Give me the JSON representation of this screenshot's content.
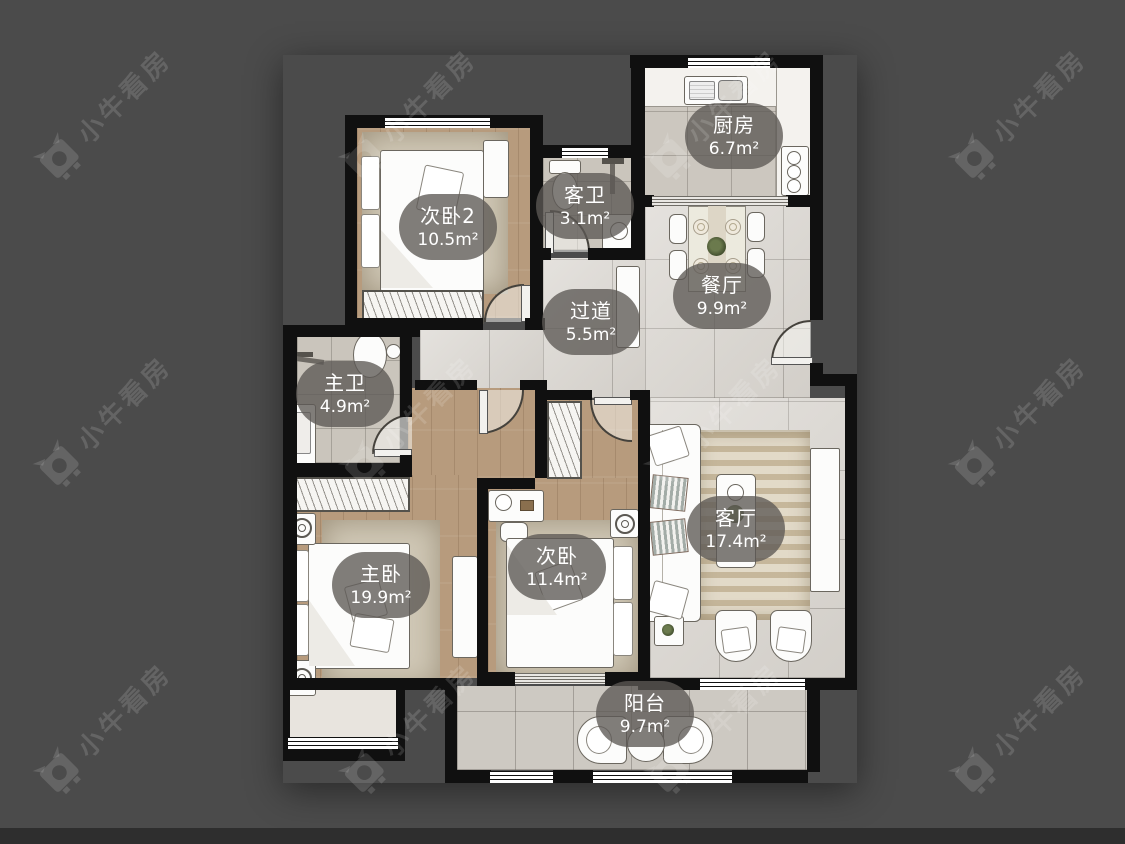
{
  "app": {
    "watermark_text": "小牛看房",
    "watermark_logo": "xiaoniu-bull-icon"
  },
  "rooms": [
    {
      "id": "bedroom2",
      "name": "次卧2",
      "area": "10.5m²"
    },
    {
      "id": "guest-bath",
      "name": "客卫",
      "area": "3.1m²"
    },
    {
      "id": "kitchen",
      "name": "厨房",
      "area": "6.7m²"
    },
    {
      "id": "hallway",
      "name": "过道",
      "area": "5.5m²"
    },
    {
      "id": "dining",
      "name": "餐厅",
      "area": "9.9m²"
    },
    {
      "id": "master-bath",
      "name": "主卫",
      "area": "4.9m²"
    },
    {
      "id": "master-bedroom",
      "name": "主卧",
      "area": "19.9m²"
    },
    {
      "id": "bedroom",
      "name": "次卧",
      "area": "11.4m²"
    },
    {
      "id": "living",
      "name": "客厅",
      "area": "17.4m²"
    },
    {
      "id": "balcony",
      "name": "阳台",
      "area": "9.7m²"
    }
  ],
  "colors": {
    "background": "#4b4b4b",
    "wall": "#101010",
    "wood_floor": "#b79b7d",
    "tile_floor": "#d9d5cf",
    "bath_tile": "#cac5bc",
    "kitchen_tile": "#ccc7bf",
    "balcony_tile": "#cdc9c2",
    "label_bubble": "rgba(92,89,85,0.78)",
    "label_text": "#ffffff",
    "watermark": "rgba(255,255,255,0.14)"
  }
}
